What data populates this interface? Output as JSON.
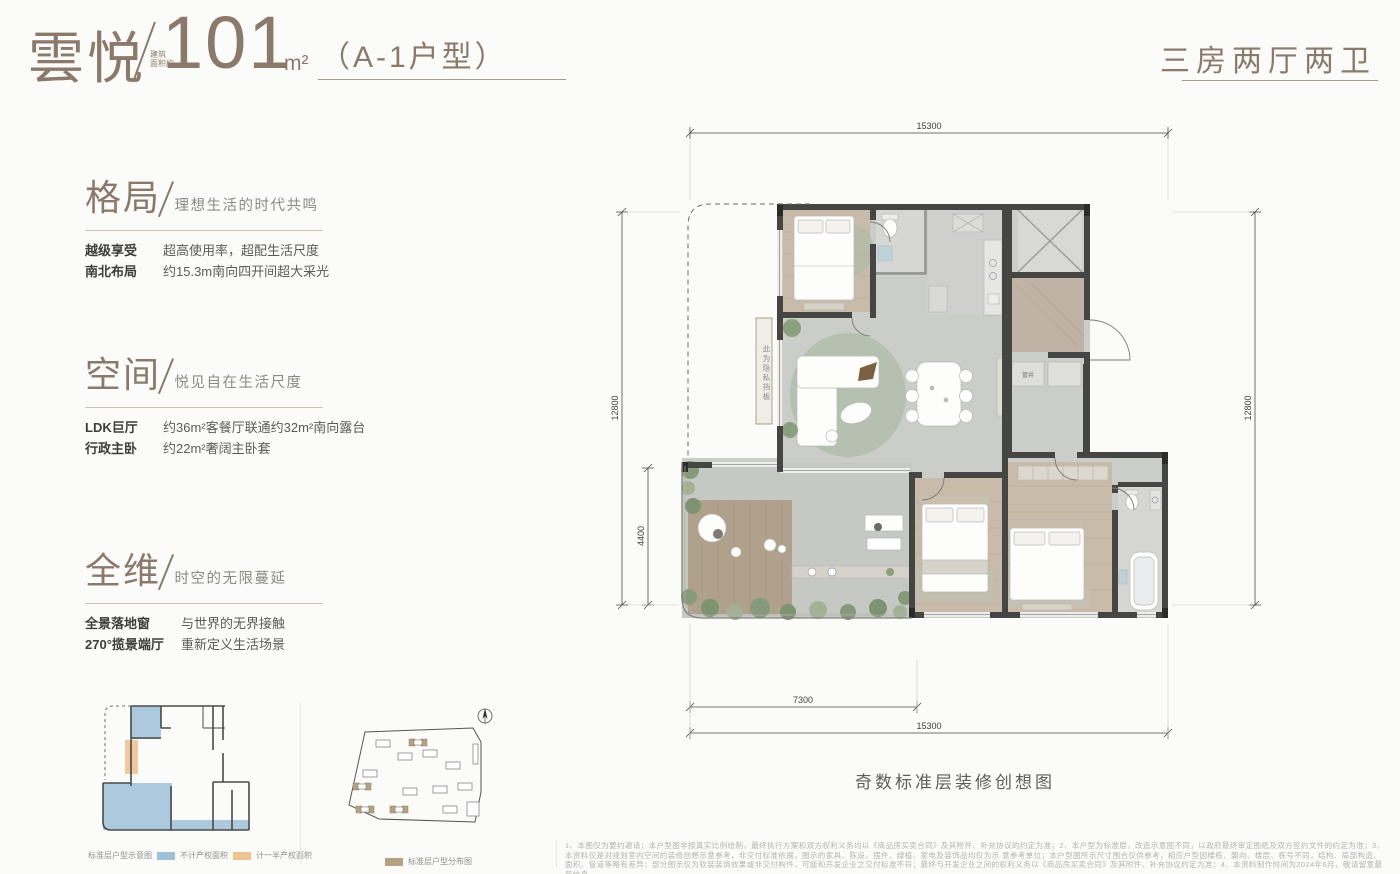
{
  "page": {
    "bg": "#fbfbf9",
    "accent": "#8b7a6c"
  },
  "header": {
    "project_name": "雲悦",
    "area_note_line1": "建筑",
    "area_note_line2": "面积约",
    "area_value": "101",
    "area_unit": "m²",
    "unit_type": "（A-1户型）",
    "layout_summary": "三房两厅两卫"
  },
  "sections": [
    {
      "title": "格局",
      "subtitle": "理想生活的时代共鸣",
      "rows": [
        {
          "label": "越级享受",
          "text": "超高使用率，超配生活尺度"
        },
        {
          "label": "南北布局",
          "text": "约15.3m南向四开间超大采光"
        }
      ]
    },
    {
      "title": "空间",
      "subtitle": "悦见自在生活尺度",
      "rows": [
        {
          "label": "LDK巨厅",
          "text": "约36m²客餐厅联通约32m²南向露台"
        },
        {
          "label": "行政主卧",
          "text": "约22m²奢阔主卧套"
        }
      ]
    },
    {
      "title": "全维",
      "subtitle": "时空的无限蔓延",
      "rows": [
        {
          "label": "全景落地窗",
          "text": "与世界的无界接触"
        },
        {
          "label": "270°揽景端厅",
          "text": "重新定义生活场景"
        }
      ]
    }
  ],
  "floorplan": {
    "caption": "奇数标准层装修创想图",
    "privacy_note": "此为隐私挡板",
    "shaft_label": "管井",
    "dims": {
      "top": "15300",
      "left_main": "12800",
      "left_lower": "4400",
      "right": "12800",
      "bottom_inner": "7300",
      "bottom_full": "15300"
    }
  },
  "mini_plan": {
    "caption": "标准层户型示意图",
    "legend": [
      {
        "color": "#9fc0d8",
        "label": "不计产权面积"
      },
      {
        "color": "#eec291",
        "label": "计一半产权面积"
      }
    ]
  },
  "site_plan": {
    "caption": "标准层户型分布图",
    "highlight_color": "#b5a284"
  },
  "disclaimer": {
    "line1": "1、本图仅为要约邀请；本户型图非按真实比例绘制，最终执行方案和双方权利义务均以《商品房买卖合同》及其附件、补充协议的约定为准；2、本户型为标准层，改造示意图不同，以政府最终审定图纸及双方签约文件的约定为准；3、本资料仅是对规划室内空间的装修创想示意参考，非交付标准依据，图示的家具、陈设、摆件、绿植、家电及装饰品均仅为示",
    "line2": "意参考单位；本户型图所示尺寸围合仅供参考，相应户型因楼栋、朝向、楼层、栋号不同，结构、局部构造、面积、管道等略有差异；部分图示仅为软装装饰效果或非交付构件，可能和开发企业之交付标准不符；最终与开发企业之间的权利义务以《商品房买卖合同》及其附件、补充协议约定为准；4、本资料制作时间为2024年6月，敬请留意最新信息。"
  }
}
